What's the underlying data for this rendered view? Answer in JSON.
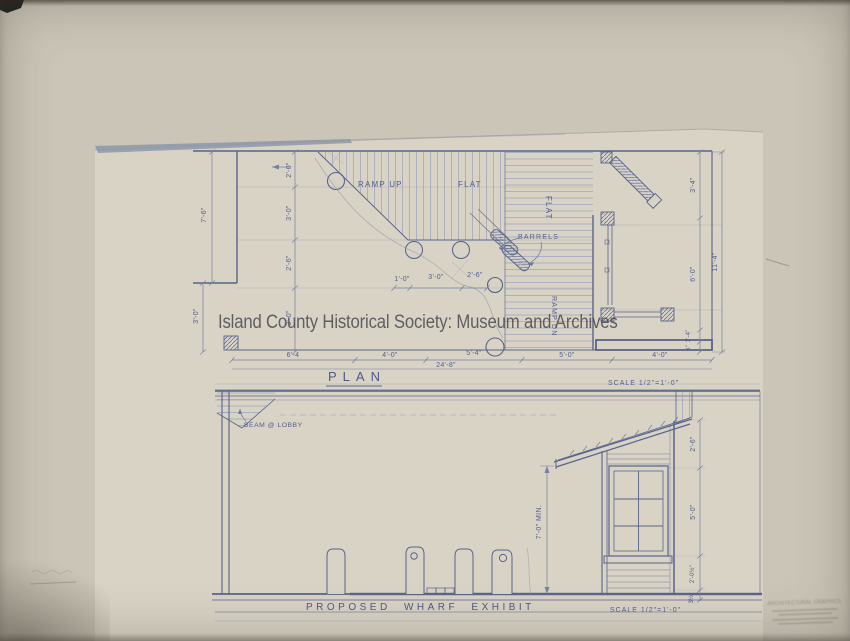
{
  "watermark": {
    "text": "Island County Historical Society: Museum and Archives"
  },
  "plan": {
    "title": "PLAN",
    "scale_note": "SCALE 1/2\"=1'-0\"",
    "labels": {
      "ramp_up": "RAMP UP",
      "flat_upper": "FLAT",
      "flat_deck": "FLAT",
      "barrels": "BARRELS",
      "ramp_dn": "RAMP DN"
    },
    "dims": {
      "left_outer": [
        "7'-6\"",
        "3'-0\""
      ],
      "left_inner": [
        "2'-0\"",
        "3'-0\"",
        "2'-6\"",
        "3'-0\""
      ],
      "middle": [
        "1'-0\"",
        "3'-0\"",
        "2'-6\""
      ],
      "bottom": [
        "6'-4",
        "4'-0\"",
        "5'-4\"",
        "5'-0\"",
        "4'-0\""
      ],
      "bottom_overall": "24'-8\"",
      "right_inner": [
        "3'-4\"",
        "6'-0\"",
        "1'-4\"",
        "6\""
      ],
      "right_outer": "11'-4\""
    }
  },
  "elevation": {
    "title": "PROPOSED WHARF EXHIBIT",
    "scale_note": "SCALE 1/2\"=1'-0\"",
    "labels": {
      "beam": "BEAM @ LOBBY",
      "min_height": "7'-0\" MIN."
    },
    "dims": {
      "right": [
        "2'-6\"",
        "5'-0\"",
        "2'-0½\"",
        "3½\""
      ]
    }
  },
  "stamp": {
    "line1": "ARCHITECTURAL GRAPHICS"
  }
}
